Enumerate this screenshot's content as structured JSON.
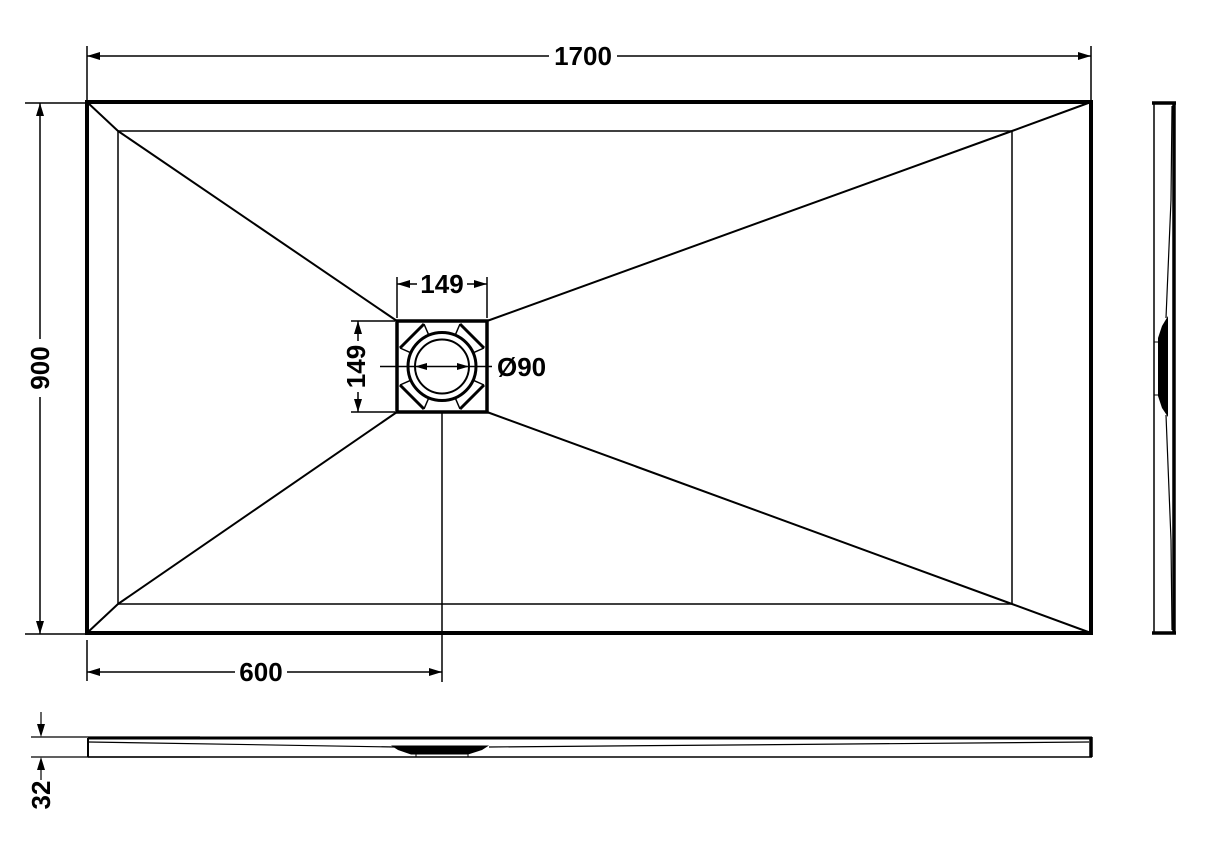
{
  "drawing": {
    "background": "#ffffff",
    "line_color": "#000000",
    "plan": {
      "length_label": "1700",
      "width_label": "900",
      "drain_offset_label": "600",
      "drain_square_width_label": "149",
      "drain_square_height_label": "149",
      "drain_diameter_label": "Ø90"
    },
    "front": {
      "thickness_label": "32"
    }
  }
}
